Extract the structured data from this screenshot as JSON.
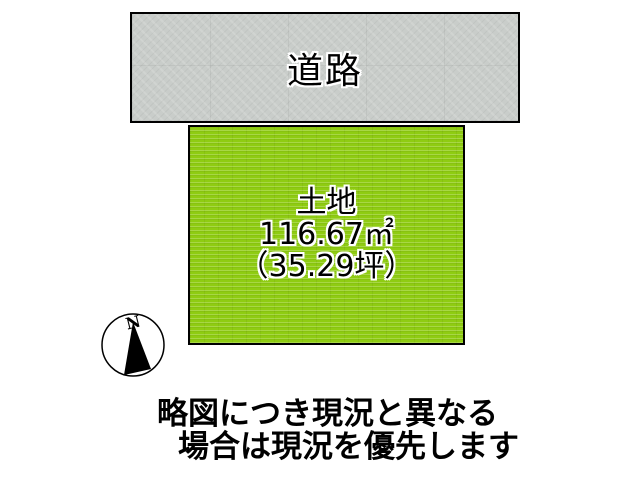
{
  "figure": {
    "road": {
      "label": "道路"
    },
    "land": {
      "name": "土地",
      "area_sqm": "116.67㎡",
      "area_tsubo": "（35.29坪）"
    },
    "compass": {
      "north": "N"
    },
    "note": {
      "line1": "略図につき現況と異なる",
      "line2": "場合は現況を優先します"
    },
    "colors": {
      "road_fill": "#c9cdca",
      "land_fill": "#8fcc12",
      "outline": "#000000",
      "background": "#ffffff",
      "text": "#000000",
      "text_halo": "#ffffff"
    }
  }
}
